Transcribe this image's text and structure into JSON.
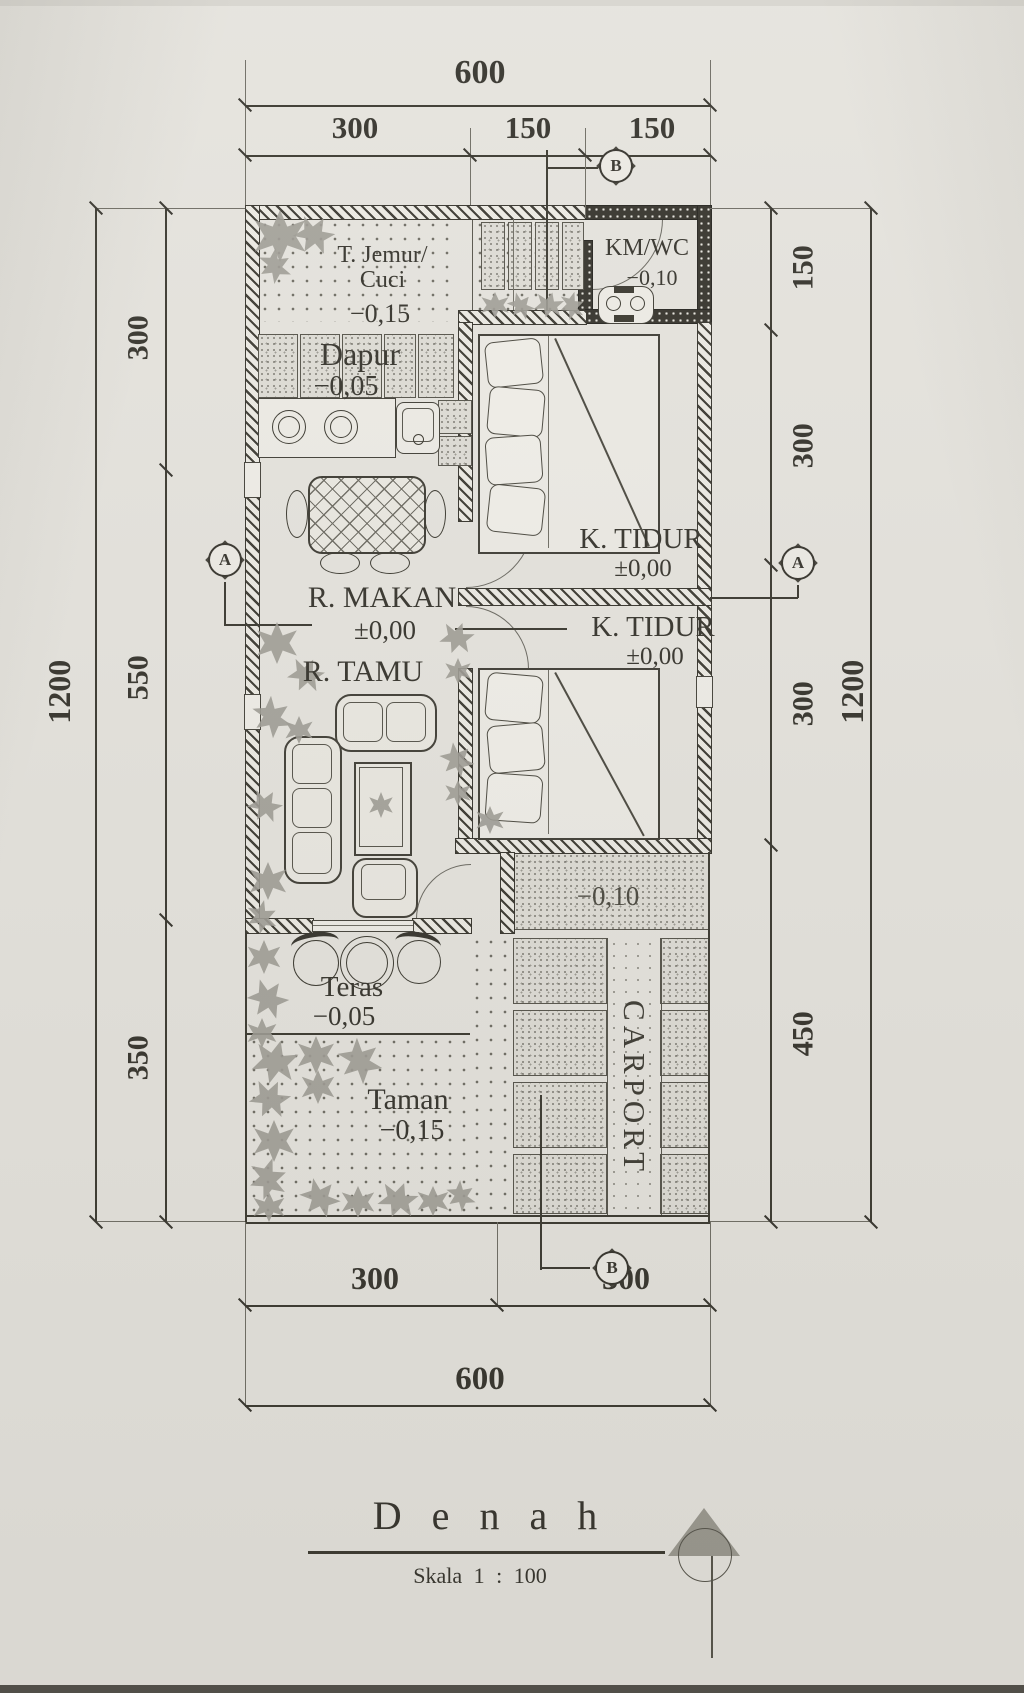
{
  "title": {
    "name": "D e n a h",
    "scale": "Skala   1  :  100"
  },
  "rooms": {
    "jemur": {
      "line1": "T. Jemur/",
      "line2": "Cuci",
      "level": "−0,15"
    },
    "dapur": {
      "name": "Dapur",
      "level": "−0,05"
    },
    "kmwc": {
      "name": "KM/WC",
      "level": "−0,10"
    },
    "tidur1": {
      "name": "K. TIDUR",
      "level": "±0,00"
    },
    "tidur2": {
      "name": "K. TIDUR",
      "level": "±0,00"
    },
    "makan": {
      "name": "R. MAKAN",
      "level": "±0,00"
    },
    "tamu": {
      "name": "R. TAMU"
    },
    "teras": {
      "name": "Teras",
      "level": "−0,05"
    },
    "taman": {
      "name": "Taman",
      "level": "−0,15"
    },
    "carport": {
      "name": "CARPORT",
      "level": "−0,10"
    }
  },
  "dimensions": {
    "top": {
      "total": "600",
      "segments": [
        "300",
        "150",
        "150"
      ]
    },
    "bottom": {
      "segments": [
        "300",
        "300"
      ],
      "total": "600"
    },
    "left": {
      "total": "1200",
      "segments": [
        "300",
        "550",
        "350"
      ]
    },
    "right": {
      "total": "1200",
      "segments": [
        "150",
        "300",
        "300",
        "450"
      ]
    }
  },
  "markers": {
    "section_a": "A",
    "section_b": "B"
  },
  "colors": {
    "paper": "#e5e3dd",
    "ink": "#35332c"
  }
}
